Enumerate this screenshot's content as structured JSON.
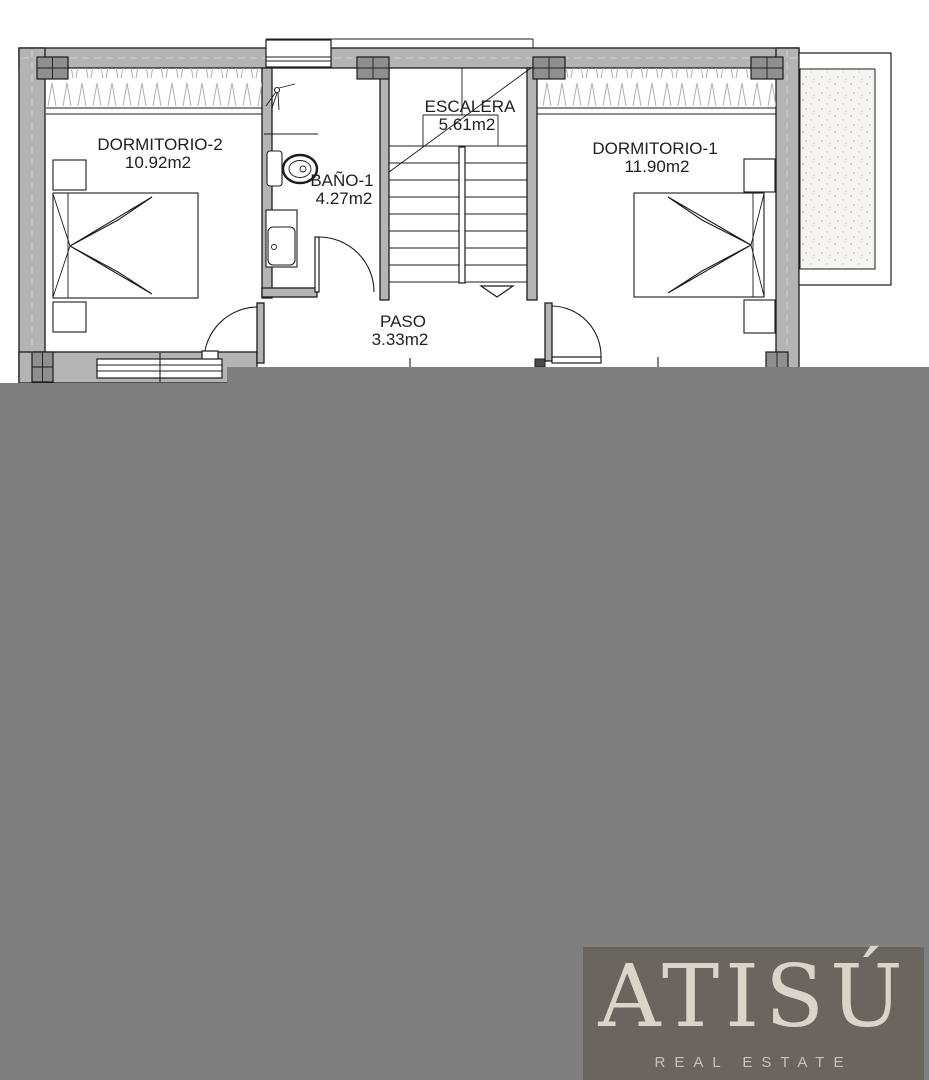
{
  "plan": {
    "floor_type": "floor-plan",
    "rooms": [
      {
        "name": "DORMITORIO-2",
        "area": "10.92m2"
      },
      {
        "name": "BAÑO-1",
        "area": "4.27m2"
      },
      {
        "name": "ESCALERA",
        "area": "5.61m2"
      },
      {
        "name": "DORMITORIO-1",
        "area": "11.90m2"
      },
      {
        "name": "PASO",
        "area": "3.33m2"
      }
    ]
  },
  "watermark": {
    "brand": "ATISÚ",
    "tagline": "REAL ESTATE"
  },
  "colors": {
    "line": "#1c1c1c",
    "wall-fill": "#b4b4b4",
    "pillar-fill": "#8f8f8f",
    "overlay": "#7f7f7f",
    "logo-bg": "#6b655f",
    "logo-text": "#dbd4c8",
    "logo-sub": "#c9c2b7",
    "paper": "#ffffff"
  }
}
